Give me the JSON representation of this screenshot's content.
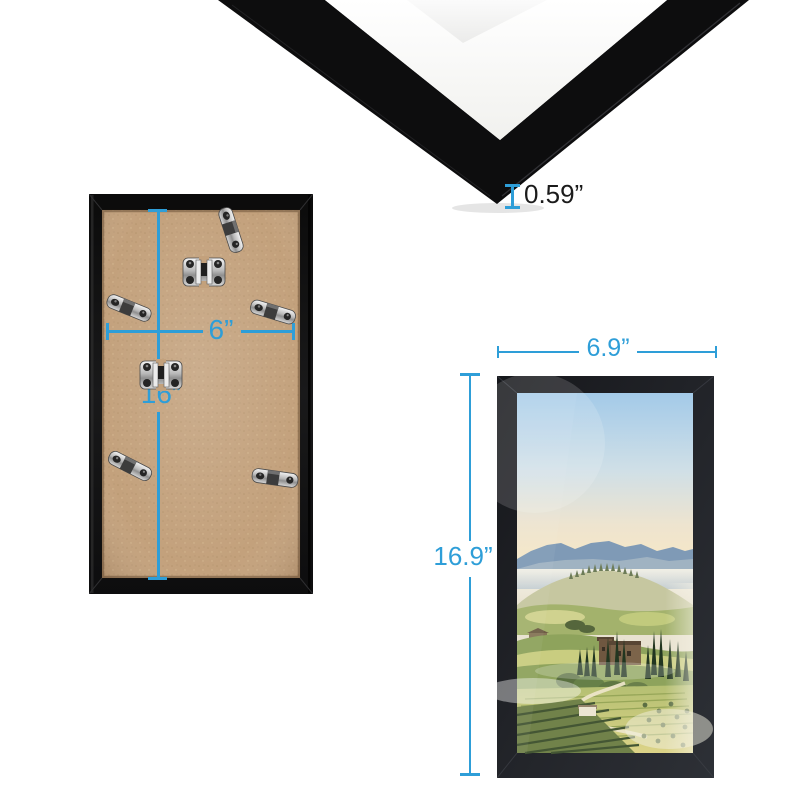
{
  "canvas": {
    "width": 800,
    "height": 800,
    "background": "#ffffff"
  },
  "colors": {
    "dimension_blue": "#2e9ed8",
    "measurement_text_dark": "#1b1b1b",
    "frame_black": "#0d0d0e",
    "mat_white": "#fbfbfa",
    "backing_board_tan": "#c3a17c"
  },
  "views": {
    "corner_closeup": {
      "thickness_label": "0.59”"
    },
    "back": {
      "width_label": "6”",
      "height_label": "16”"
    },
    "front": {
      "width_label": "6.9”",
      "height_label": "16.9”"
    }
  }
}
